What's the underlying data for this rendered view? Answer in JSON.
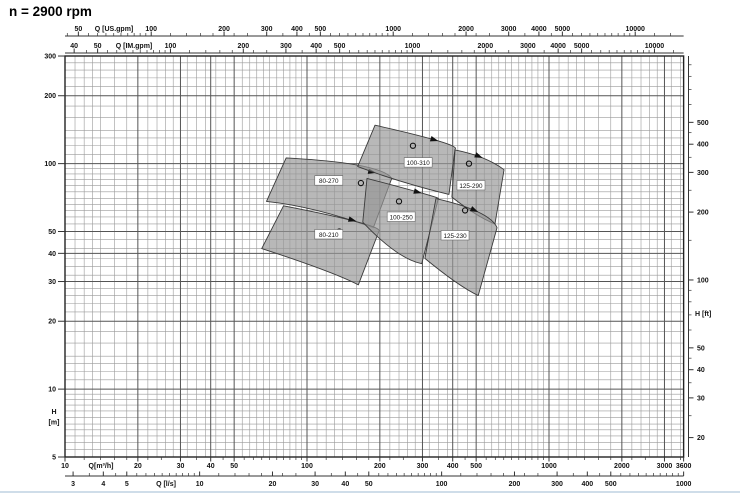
{
  "title": "n = 2900 rpm",
  "chart_data": {
    "type": "area",
    "subtype": "pump-selection-envelope-chart",
    "title": "n = 2900 rpm",
    "grid": "on",
    "scales": "log-log",
    "axes": {
      "top_us_gpm": {
        "title": "Q [US.gpm]",
        "labeled_ticks": [
          50,
          100,
          200,
          300,
          400,
          500,
          1000,
          2000,
          3000,
          4000,
          5000,
          10000
        ]
      },
      "top_im_gpm": {
        "title": "Q [IM.gpm]",
        "labeled_ticks": [
          40,
          50,
          100,
          200,
          300,
          400,
          500,
          1000,
          2000,
          3000,
          4000,
          5000,
          10000
        ]
      },
      "bottom_m3h": {
        "title": "Q[m³/h]",
        "labeled_ticks": [
          10,
          20,
          30,
          40,
          50,
          100,
          200,
          300,
          400,
          500,
          1000,
          2000,
          3000,
          3600
        ],
        "range": [
          10,
          3600
        ]
      },
      "bottom_ls": {
        "title": "Q [l/s]",
        "labeled_ticks": [
          3,
          4,
          5,
          10,
          20,
          30,
          40,
          50,
          100,
          200,
          300,
          400,
          500,
          1000
        ]
      },
      "left_m": {
        "title_lines": [
          "H",
          "[m]"
        ],
        "labeled_ticks": [
          5,
          10,
          20,
          30,
          40,
          50,
          100,
          200,
          300
        ],
        "range": [
          5,
          300
        ]
      },
      "right_ft": {
        "title": "H [ft]",
        "labeled_ticks": [
          20,
          30,
          40,
          50,
          100,
          200,
          300,
          400,
          500
        ],
        "minor_ticks": [
          25,
          35,
          45,
          60,
          70,
          80,
          90,
          150,
          250,
          350,
          450,
          600,
          700,
          800,
          900
        ]
      }
    },
    "unit_conversions": {
      "us_gpm_per_m3h": 4.4029,
      "im_gpm_per_m3h": 3.6662,
      "l_s_per_m3h": 0.27778
    },
    "series": [
      {
        "name": "80-270",
        "envelope": {
          "tl": [
            82,
            106
          ],
          "top_mid": [
            166,
            98
          ],
          "tr": [
            224,
            86
          ],
          "br": [
            188,
            52
          ],
          "bottom_mid": [
            110,
            62
          ],
          "bl": [
            68,
            68
          ]
        },
        "label_at": [
          123,
          84
        ],
        "marker_at": [
          167,
          82
        ],
        "arrow_at": [
          193,
          91
        ],
        "arrow_angle": 12
      },
      {
        "name": "80-210",
        "envelope": {
          "tl": [
            80,
            65
          ],
          "top_mid": [
            163,
            55
          ],
          "tr": [
            198,
            50
          ],
          "br": [
            163,
            29
          ],
          "bottom_mid": [
            115,
            34
          ],
          "bl": [
            65,
            42
          ]
        },
        "label_at": [
          123,
          48.5
        ],
        "marker_at": [
          136,
          50
        ],
        "arrow_at": [
          160,
          55.5
        ],
        "arrow_angle": 16
      },
      {
        "name": "100-310",
        "envelope": {
          "tl": [
            191,
            148
          ],
          "top_mid": [
            349,
            126
          ],
          "tr": [
            409,
            116
          ],
          "br": [
            386,
            73
          ],
          "bottom_mid": [
            249,
            83
          ],
          "bl": [
            162,
            97
          ]
        },
        "label_at": [
          288,
          101
        ],
        "marker_at": [
          274,
          120
        ],
        "arrow_at": [
          349,
          126
        ],
        "arrow_angle": 17
      },
      {
        "name": "100-250",
        "envelope": {
          "tl": [
            177,
            86
          ],
          "top_mid": [
            298,
            74
          ],
          "tr": [
            349,
            70
          ],
          "br": [
            298,
            36
          ],
          "bottom_mid": [
            231,
            41
          ],
          "bl": [
            170,
            55
          ]
        },
        "label_at": [
          245,
          58
        ],
        "marker_at": [
          240,
          68
        ],
        "arrow_at": [
          298,
          74
        ],
        "arrow_angle": 15
      },
      {
        "name": "125-290",
        "envelope": {
          "tl": [
            409,
            115
          ],
          "top_mid": [
            532,
            106
          ],
          "tr": [
            652,
            94
          ],
          "br": [
            598,
            54
          ],
          "bottom_mid": [
            495,
            60
          ],
          "bl": [
            397,
            71
          ]
        },
        "label_at": [
          476,
          80
        ],
        "marker_at": [
          467,
          100
        ],
        "arrow_at": [
          532,
          106
        ],
        "arrow_angle": 23
      },
      {
        "name": "125-230",
        "envelope": {
          "tl": [
            341,
            70
          ],
          "top_mid": [
            510,
            61
          ],
          "tr": [
            610,
            52
          ],
          "br": [
            510,
            26
          ],
          "bottom_mid": [
            409,
            30
          ],
          "bl": [
            307,
            38
          ]
        },
        "label_at": [
          409,
          48
        ],
        "marker_at": [
          450,
          62
        ],
        "arrow_at": [
          510,
          61
        ],
        "arrow_angle": 25
      }
    ],
    "grid_mantissas": {
      "minor": [
        1,
        1.1,
        1.2,
        1.3,
        1.4,
        1.6,
        1.8,
        2,
        2.2,
        2.4,
        2.6,
        2.8,
        3,
        3.2,
        3.5,
        3.8,
        4.2,
        4.6,
        5,
        5.4,
        5.8,
        6.2,
        6.6,
        7,
        7.5,
        8,
        8.5,
        9,
        9.5
      ],
      "scale_ticks": [
        1,
        1.2,
        1.4,
        1.6,
        1.8,
        2,
        2.2,
        2.5,
        3,
        3.5,
        4,
        4.5,
        5,
        5.5,
        6,
        6.5,
        7,
        7.5,
        8,
        8.5,
        9,
        9.5
      ],
      "major_vertical_q": [
        20,
        30,
        40,
        50,
        100,
        200,
        300,
        400,
        500,
        1000,
        2000,
        3000
      ],
      "major_horizontal_h": [
        10,
        20,
        30,
        40,
        50,
        100,
        200
      ]
    },
    "colors": {
      "envelope_fill": "rgba(150,150,150,0.68)",
      "envelope_stroke": "#3a3a3a",
      "grid_minor": "#9a9a9a",
      "grid_major": "#555555",
      "frame": "#222222",
      "text": "#111111",
      "marker": "#111111",
      "label_box_border": "#666666"
    }
  }
}
